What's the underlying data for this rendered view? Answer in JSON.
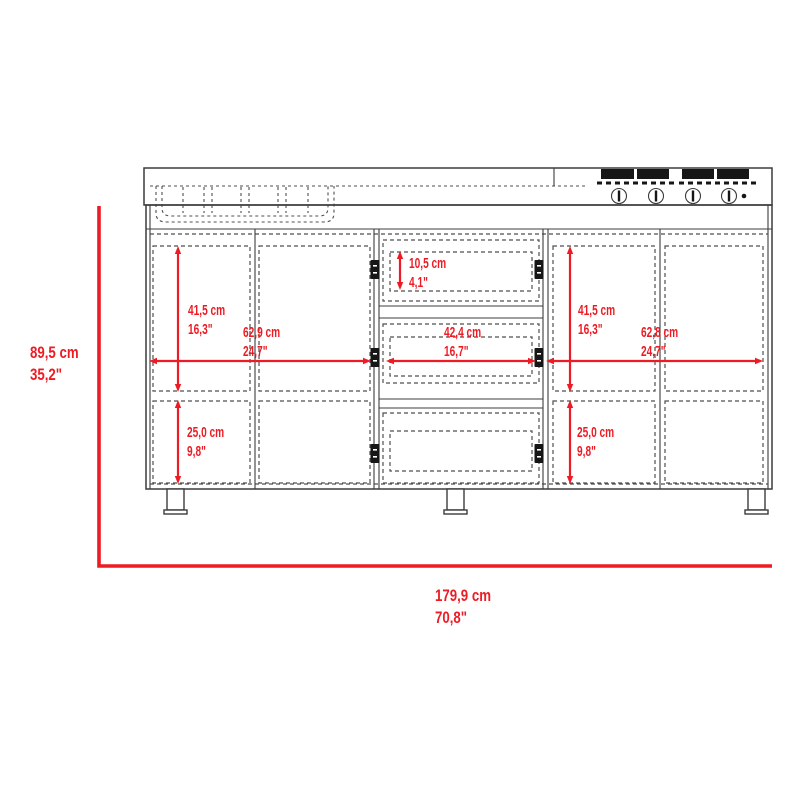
{
  "colors": {
    "red": "#ed1c24",
    "line": "#3c3c3c",
    "dash": "#4f4f4f",
    "black": "#161616",
    "bg": "#ffffff"
  },
  "dimensions": {
    "overall_height": {
      "cm": "89,5 cm",
      "in": "35,2\""
    },
    "overall_width": {
      "cm": "179,9 cm",
      "in": "70,8\""
    },
    "left_door_height": {
      "cm": "41,5 cm",
      "in": "16,3\""
    },
    "left_section_width": {
      "cm": "62,9 cm",
      "in": "24,7\""
    },
    "left_lower_height": {
      "cm": "25,0 cm",
      "in": "9,8\""
    },
    "top_drawer_height": {
      "cm": "10,5 cm",
      "in": "4,1\""
    },
    "drawer_width": {
      "cm": "42,4 cm",
      "in": "16,7\""
    },
    "right_door_height": {
      "cm": "41,5 cm",
      "in": "16,3\""
    },
    "right_section_width": {
      "cm": "62,8 cm",
      "in": "24,7\""
    },
    "right_lower_height": {
      "cm": "25,0 cm",
      "in": "9,8\""
    }
  }
}
